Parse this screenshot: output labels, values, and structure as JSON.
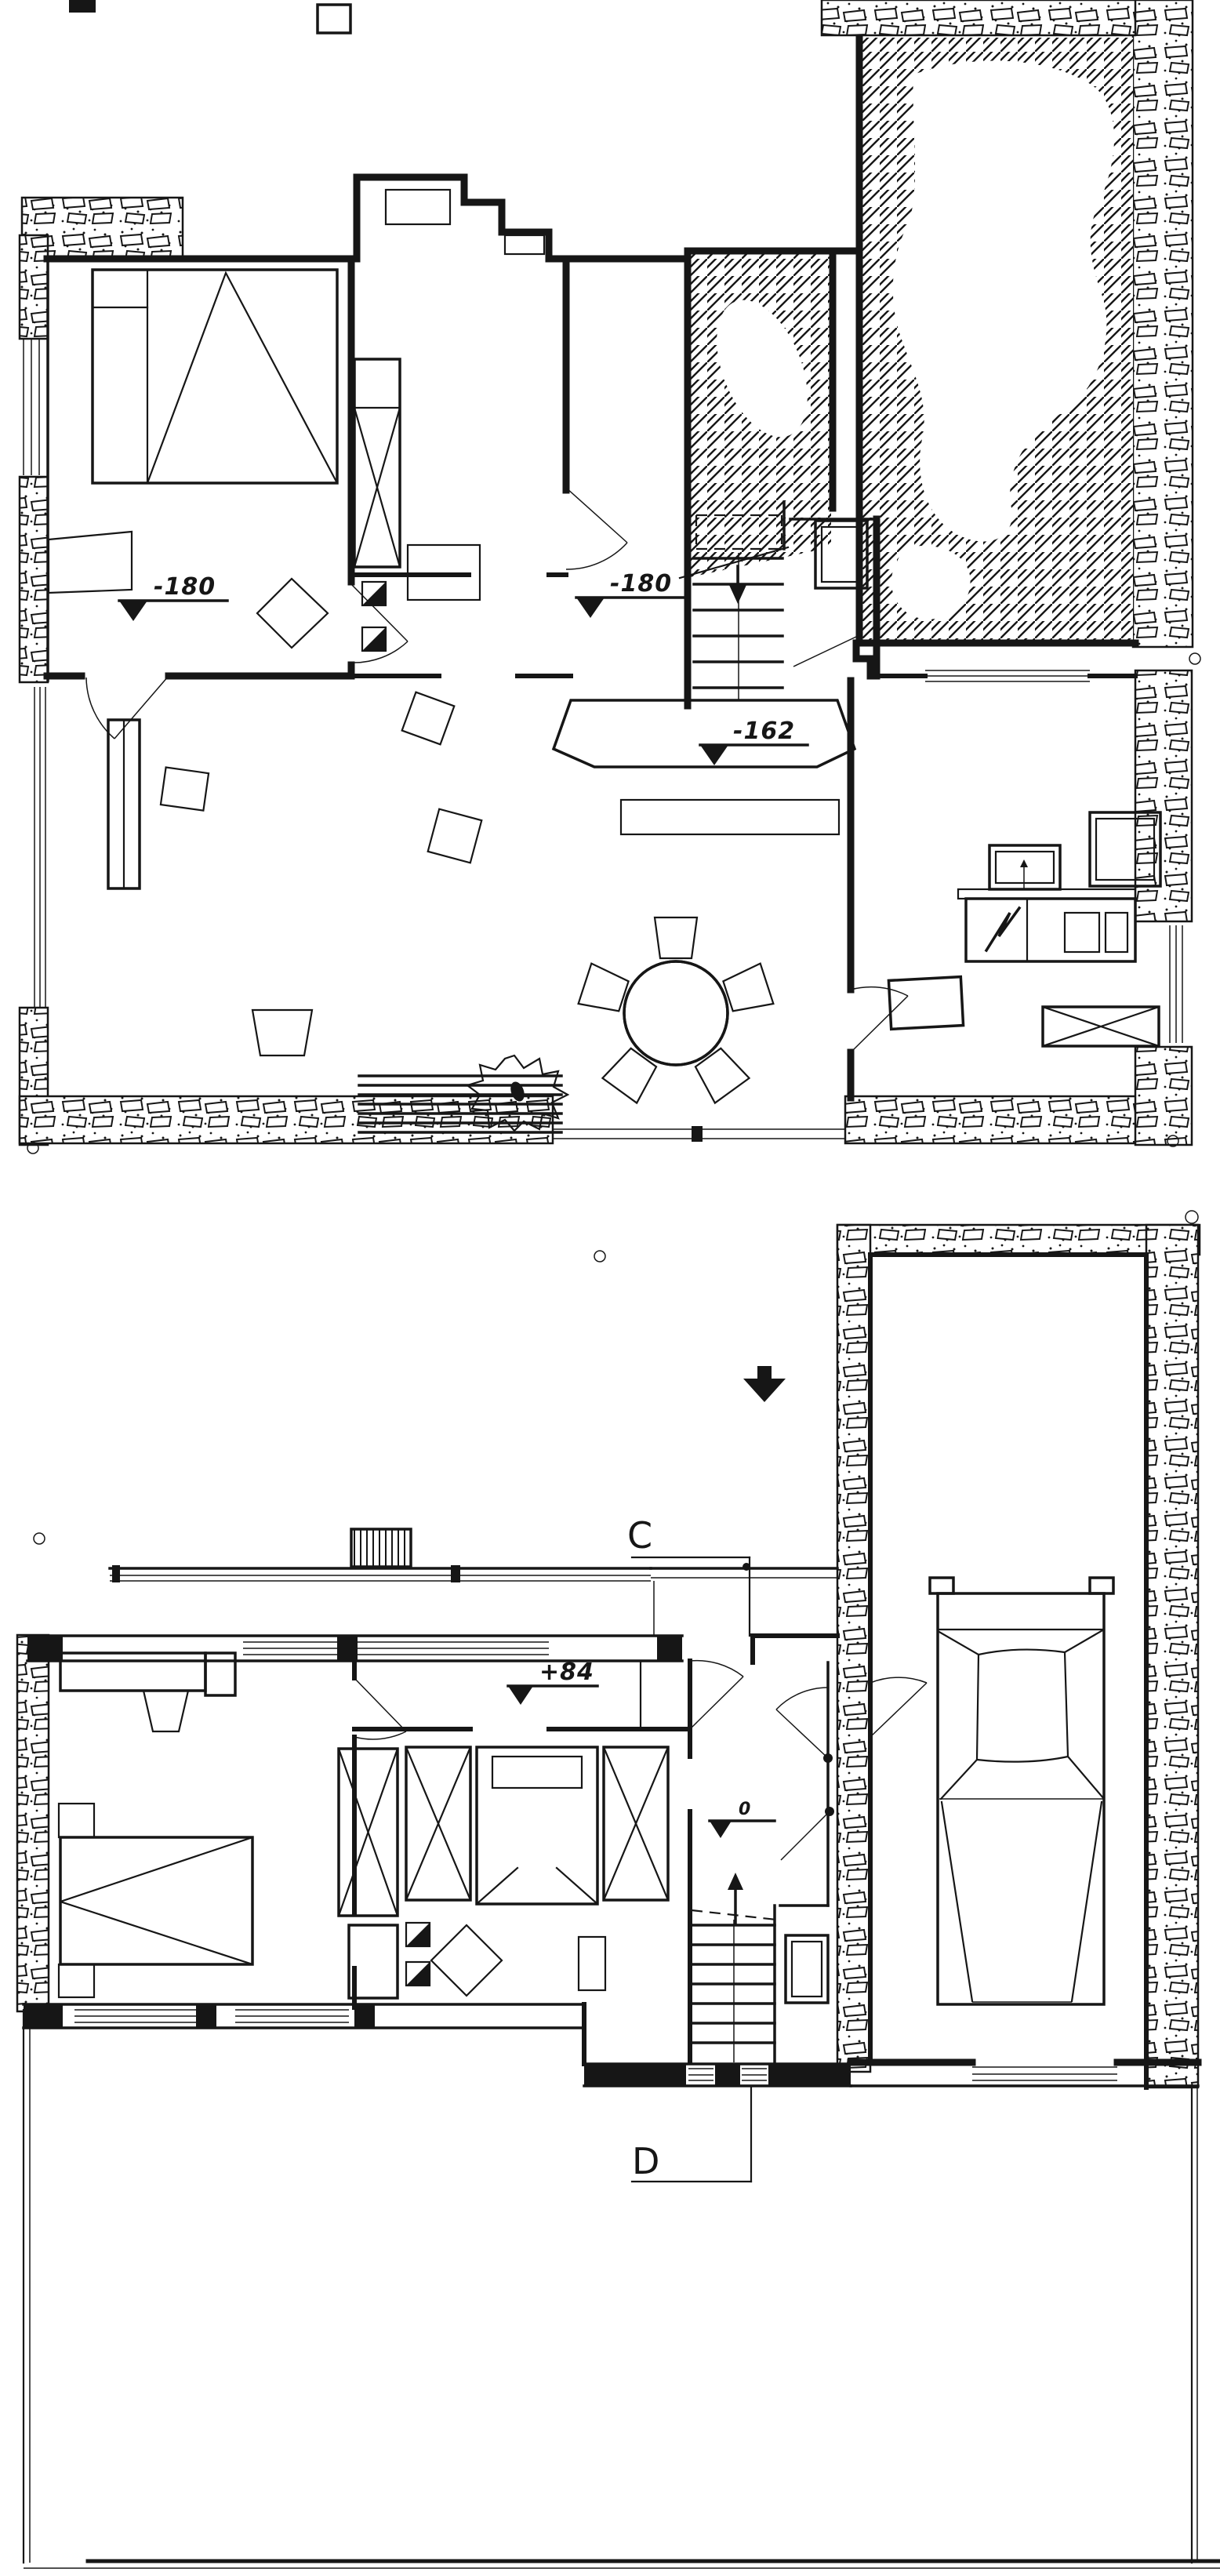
{
  "colors": {
    "ink": "#161616",
    "paper": "#ffffff"
  },
  "plans": [
    {
      "id": "upper-drawing",
      "level_markers": [
        {
          "id": "bedroom-level",
          "label": "-180"
        },
        {
          "id": "hall-level",
          "label": "-180"
        },
        {
          "id": "living-level",
          "label": "-162"
        }
      ],
      "features": [
        "rubble-masonry-walls",
        "hatched-terrace",
        "terrace-blobs",
        "bed",
        "wardrobe-x",
        "stairs-down-arrow",
        "wc-fixture",
        "dining-table-5-chairs",
        "plant",
        "garden-steps",
        "kitchen-counter",
        "electric-stove",
        "double-sink",
        "door-swings",
        "corner-post-circles"
      ]
    },
    {
      "id": "lower-drawing",
      "level_markers": [
        {
          "id": "hall-level",
          "label": "+84"
        },
        {
          "id": "landing-level",
          "label": "0"
        }
      ],
      "section_markers": [
        {
          "label": "C"
        },
        {
          "label": "D"
        }
      ],
      "features": [
        "garage",
        "car",
        "chimney",
        "roof-terrace-railing",
        "desk-and-chair",
        "beds",
        "wardrobes-x",
        "stairs-up-arrow",
        "wc-fixture",
        "north-arrow",
        "survey-circles",
        "site-boundary-lines"
      ]
    }
  ]
}
